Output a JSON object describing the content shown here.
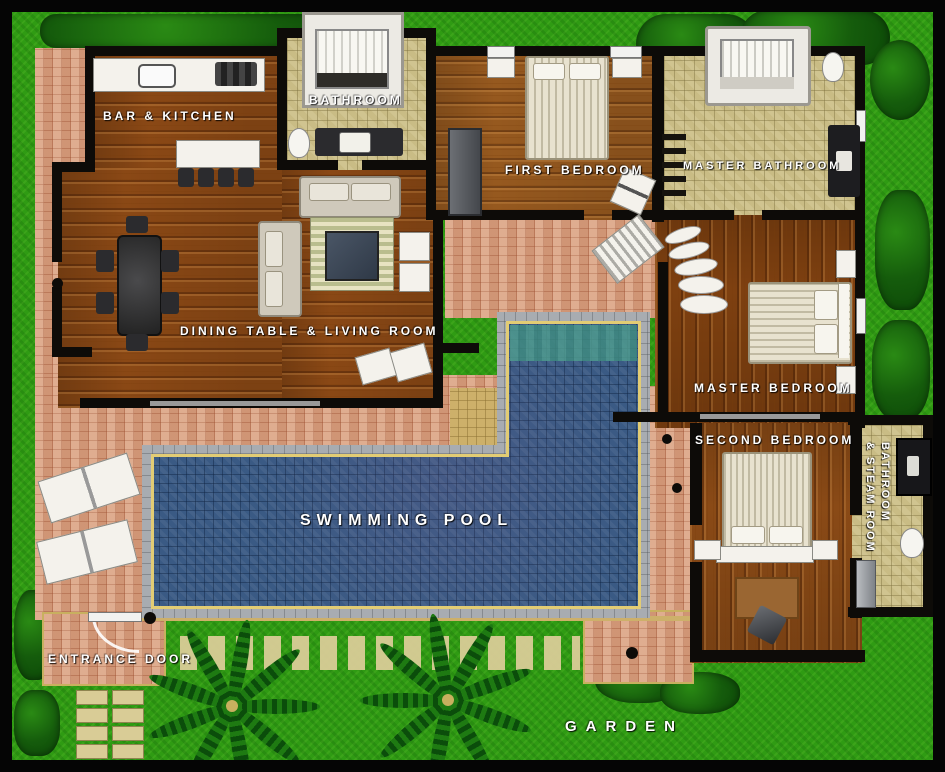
{
  "plan": {
    "labels": {
      "bar_kitchen": "BAR & KITCHEN",
      "bathroom": "BATHROOM",
      "first_bedroom": "FIRST BEDROOM",
      "master_bathroom": "MASTER BATHROOM",
      "dining_living": "DINING TABLE & LIVING ROOM",
      "master_bedroom": "MASTER BEDROOM",
      "second_bedroom": "SECOND BEDROOM",
      "bathroom_steam_line1": "BATHROOM",
      "bathroom_steam_line2": "& STEAM ROOM",
      "swimming_pool": "SWIMMING POOL",
      "entrance_door": "ENTRANCE DOOR",
      "garden": "GARDEN"
    },
    "colors": {
      "grass": "#2f9b13",
      "bush": "#155c0c",
      "terracotta": "#d8a183",
      "bath_tile": "#c9bc85",
      "wood": "#8a4815",
      "pool_water": "#3a5a84",
      "pool_border": "#a8acb1",
      "pool_trim": "#e2cc74",
      "wall": "#0d0b08",
      "label_text": "#ffffff"
    }
  }
}
